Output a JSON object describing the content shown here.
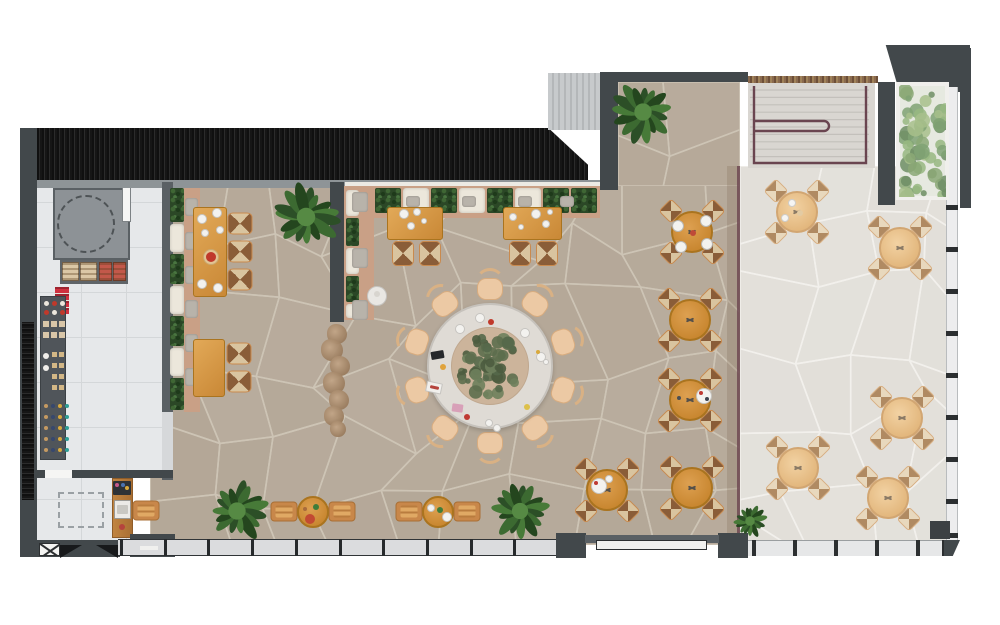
{
  "scene": {
    "description": "Top-down 3D rendered floor plan of a restaurant: kitchen with shelving at left, host desk, indoor dining room with banquettes and flagstone floor, large communal round table with planted centerpiece, staircase at top right, and an outdoor terrace with five tables",
    "visible_text": "none"
  },
  "palette": {
    "wall_dark": "#42484b",
    "wall_black": "#161616",
    "stone_indoor": "#b4a797",
    "stone_grout": "#cdc4b5",
    "terrace": "#e2dfd9",
    "kitchen_tile": "#e6e8ea",
    "wood_table": "#d0903d",
    "terrace_wood": "#e9c291",
    "banquette_tan": "#c9a086",
    "hedge_green": "#2b4726",
    "cushion_cream": "#ece7db",
    "railing_maroon": "#6a4550",
    "accent_red": "#c0392b",
    "plant_green": "#3c6a31"
  },
  "floors": [
    {
      "name": "dining-floor",
      "cls": "stoneA",
      "x": 150,
      "y": 182,
      "w": 590,
      "h": 363,
      "mesh": "in",
      "seed": 11
    },
    {
      "name": "dining-floor-extension",
      "cls": "stoneA",
      "x": 618,
      "y": 82,
      "w": 122,
      "h": 104,
      "mesh": "in",
      "seed": 23
    },
    {
      "name": "terrace-floor",
      "cls": "stoneT",
      "x": 740,
      "y": 166,
      "w": 208,
      "h": 376,
      "mesh": "ter",
      "seed": 37
    },
    {
      "name": "stair-floor",
      "cls": "stairf",
      "x": 748,
      "y": 82,
      "w": 127,
      "h": 86,
      "mesh": "none",
      "seed": 1
    },
    {
      "name": "kitchen-floor",
      "cls": "tile",
      "x": 37,
      "y": 186,
      "w": 125,
      "h": 286,
      "mesh": "none",
      "seed": 1
    },
    {
      "name": "host-floor",
      "cls": "tile",
      "x": 37,
      "y": 478,
      "w": 96,
      "h": 66,
      "mesh": "none",
      "seed": 1
    }
  ],
  "kitchen": {
    "dark_zone": [
      53,
      188,
      77,
      72
    ],
    "dashed_circle": [
      86,
      224,
      29
    ],
    "door": [
      122,
      184,
      9,
      38
    ],
    "counter": [
      60,
      260,
      68,
      24
    ],
    "crates": [
      [
        62,
        262,
        17,
        19,
        "#dbc7a6"
      ],
      [
        80,
        262,
        17,
        19,
        "#dbc7a6"
      ],
      [
        99,
        262,
        13,
        19,
        "#c2584a"
      ],
      [
        113,
        262,
        13,
        19,
        "#c2584a"
      ]
    ],
    "red_stack": [
      55,
      287,
      14,
      27
    ],
    "shelf": [
      40,
      296,
      26,
      164
    ],
    "shelf_cols": [
      "#c49a62",
      "#37486e",
      "#d9a93c",
      "#2f9f96"
    ],
    "dashed_rect": [
      58,
      492,
      46,
      36
    ]
  },
  "walls": [
    {
      "name": "north-wall",
      "cls": "hatch",
      "x": 22,
      "y": 128,
      "w": 566,
      "h": 54,
      "clip": "polygon(0% 0%,93% 0%,100% 68%,100% 100%,0% 100%)",
      "shadow": true
    },
    {
      "name": "north-wall-edge",
      "cls": "grayedge",
      "x": 22,
      "y": 180,
      "w": 596,
      "h": 8
    },
    {
      "name": "west-wall",
      "cls": "dark",
      "x": 20,
      "y": 128,
      "w": 17,
      "h": 380
    },
    {
      "name": "west-wall-hatch",
      "cls": "hatchv",
      "x": 22,
      "y": 322,
      "w": 12,
      "h": 184
    },
    {
      "name": "west-wall-south",
      "cls": "dark",
      "x": 20,
      "y": 500,
      "w": 17,
      "h": 57
    },
    {
      "name": "southwest-wall",
      "cls": "dark",
      "x": 37,
      "y": 540,
      "w": 83,
      "h": 17
    },
    {
      "name": "glass-block",
      "cls": "lightblock",
      "x": 548,
      "y": 73,
      "w": 52,
      "h": 57
    },
    {
      "name": "mid-wall-strip",
      "cls": "dark",
      "x": 600,
      "y": 72,
      "w": 18,
      "h": 118
    },
    {
      "name": "mid-top-wall",
      "cls": "dark",
      "x": 600,
      "y": 72,
      "w": 148,
      "h": 10
    },
    {
      "name": "dining-partition-wall",
      "cls": "dark",
      "x": 330,
      "y": 182,
      "w": 14,
      "h": 140
    },
    {
      "name": "kitchen-partition-wall",
      "cls": "dark2",
      "x": 162,
      "y": 182,
      "w": 11,
      "h": 298
    },
    {
      "name": "kitchen-pass-window",
      "cls": "grayedge",
      "x": 162,
      "y": 412,
      "w": 11,
      "h": 58,
      "bg": "#d6d8da"
    },
    {
      "name": "host-north-wall",
      "cls": "dark",
      "x": 37,
      "y": 470,
      "w": 136,
      "h": 8
    },
    {
      "name": "host-door-leaf",
      "cls": "grayedge",
      "x": 45,
      "y": 470,
      "w": 27,
      "h": 8,
      "bg": "#f5f5f4"
    },
    {
      "name": "service-block",
      "cls": "dark",
      "x": 130,
      "y": 534,
      "w": 45,
      "h": 23
    },
    {
      "name": "northeast-corner-wall",
      "cls": "dark",
      "x": 872,
      "y": 45,
      "w": 98,
      "h": 47,
      "clip": "polygon(14% 0%,100% 0%,100% 100%,28% 100%)"
    },
    {
      "name": "northeast-vertical-wall",
      "cls": "dark",
      "x": 878,
      "y": 82,
      "w": 17,
      "h": 123
    },
    {
      "name": "far-right-wall",
      "cls": "dark",
      "x": 960,
      "y": 48,
      "w": 11,
      "h": 160
    },
    {
      "name": "stair-top-edge",
      "cls": "speckle",
      "x": 748,
      "y": 76,
      "w": 130,
      "h": 7
    }
  ],
  "banquette": {
    "north_sill": [
      345,
      182,
      255,
      7
    ],
    "north_platform": [
      345,
      186,
      255,
      32
    ],
    "north_boxes": [
      [
        347,
        "c"
      ],
      [
        375,
        "h"
      ],
      [
        403,
        "c"
      ],
      [
        431,
        "h"
      ],
      [
        459,
        "c"
      ],
      [
        487,
        "h"
      ],
      [
        515,
        "c"
      ],
      [
        543,
        "h"
      ],
      [
        571,
        "h"
      ]
    ],
    "north_box_y": 188,
    "north_box_w": 26,
    "north_box_h": 25,
    "north_pillows": [
      [
        350,
        196
      ],
      [
        406,
        196
      ],
      [
        462,
        196
      ],
      [
        518,
        196
      ],
      [
        560,
        196
      ]
    ],
    "west_platform": [
      184,
      188,
      16,
      224
    ],
    "west_boxes": [
      [
        188,
        34,
        "h"
      ],
      [
        224,
        28,
        "c"
      ],
      [
        254,
        30,
        "h"
      ],
      [
        286,
        28,
        "c"
      ],
      [
        316,
        30,
        "h"
      ],
      [
        348,
        28,
        "c"
      ],
      [
        378,
        32,
        "h"
      ]
    ],
    "west_box_x": 170,
    "west_box_w": 14,
    "west_pillows": [
      [
        185,
        198
      ],
      [
        185,
        232
      ],
      [
        185,
        266
      ],
      [
        185,
        300
      ],
      [
        185,
        334
      ],
      [
        185,
        368
      ]
    ],
    "mid_platform": [
      344,
      186,
      30,
      134
    ],
    "mid_boxes": [
      [
        190,
        26,
        "c"
      ],
      [
        218,
        28,
        "h"
      ],
      [
        248,
        26,
        "c"
      ],
      [
        276,
        26,
        "h"
      ],
      [
        304,
        14,
        "c"
      ]
    ],
    "mid_box_x": 346,
    "mid_box_w": 13,
    "mid_pillows": [
      [
        352,
        192
      ],
      [
        352,
        248
      ],
      [
        352,
        300
      ]
    ]
  },
  "tables": {
    "round4_r": 21,
    "round4_indoor": [
      [
        692,
        232
      ],
      [
        690,
        320
      ],
      [
        690,
        400
      ],
      [
        692,
        488
      ],
      [
        607,
        490
      ]
    ],
    "round4_terrace": [
      [
        797,
        212
      ],
      [
        900,
        248
      ],
      [
        902,
        418
      ],
      [
        798,
        468
      ],
      [
        888,
        498
      ]
    ],
    "two_top_r": 16,
    "two_tops": [
      [
        313,
        512
      ],
      [
        438,
        512
      ]
    ],
    "rect": [
      {
        "x": 193,
        "y": 207,
        "w": 34,
        "h": 90,
        "chairs": [
          [
            229,
            211,
            "L"
          ],
          [
            229,
            239,
            "L"
          ],
          [
            229,
            267,
            "L"
          ]
        ]
      },
      {
        "x": 193,
        "y": 339,
        "w": 32,
        "h": 58,
        "chairs": [
          [
            228,
            341,
            "L"
          ],
          [
            228,
            369,
            "L"
          ]
        ]
      },
      {
        "x": 387,
        "y": 207,
        "w": 56,
        "h": 33,
        "chairs": [
          [
            392,
            241,
            "U"
          ],
          [
            419,
            241,
            "U"
          ]
        ]
      },
      {
        "x": 503,
        "y": 207,
        "w": 59,
        "h": 33,
        "chairs": [
          [
            509,
            241,
            "U"
          ],
          [
            536,
            241,
            "U"
          ]
        ]
      }
    ],
    "communal": {
      "x": 490,
      "y": 366,
      "outer_r": 63,
      "inner_r": 39,
      "chair_dist": 77,
      "chair_angles": [
        90,
        126,
        162,
        198,
        234,
        270,
        306,
        342,
        18,
        54
      ]
    },
    "pedestal": [
      377,
      296,
      10
    ]
  },
  "plants": [
    [
      306,
      217,
      33
    ],
    [
      643,
      112,
      31
    ],
    [
      237,
      511,
      31
    ],
    [
      520,
      511,
      29
    ],
    [
      750,
      521,
      17
    ]
  ],
  "planter_bed": [
    896,
    82,
    53,
    118
  ],
  "branches": [
    [
      337,
      334,
      10
    ],
    [
      332,
      350,
      11
    ],
    [
      340,
      366,
      10
    ],
    [
      334,
      383,
      11
    ],
    [
      339,
      400,
      10
    ],
    [
      334,
      416,
      10
    ],
    [
      338,
      429,
      8
    ]
  ],
  "divider": {
    "tint": [
      727,
      166,
      13,
      376
    ],
    "line": [
      737,
      166,
      3,
      376
    ]
  },
  "stairs": {
    "zone": [
      748,
      82,
      127,
      86
    ],
    "rail_color": "#6a4550"
  },
  "windows": {
    "south_band": [
      118,
      539,
      438,
      17
    ],
    "south_post_start": 120,
    "south_post_step": 43.7,
    "south_post_count": 11,
    "terrace_band": [
      748,
      540,
      200,
      16
    ],
    "terrace_posts": [
      752,
      793,
      834,
      875,
      916,
      942
    ],
    "right_band": [
      946,
      85,
      12,
      455
    ],
    "right_posts": [
      205,
      247,
      289,
      331,
      373,
      415,
      457,
      499,
      533
    ],
    "right_cap": [
      944,
      75,
      18,
      12
    ],
    "entrance_blocks": [
      [
        556,
        533,
        30,
        25
      ],
      [
        718,
        533,
        30,
        25
      ]
    ],
    "entrance_lintel": [
      585,
      535,
      134,
      8
    ],
    "entrance_door": [
      596,
      540,
      111,
      10
    ],
    "x_window": [
      39,
      543,
      21,
      13
    ],
    "door_wedges": [
      [
        60,
        545,
        22,
        13
      ],
      [
        96,
        545,
        22,
        13
      ]
    ],
    "service_slit": [
      140,
      546,
      18,
      4
    ],
    "terrace_dark_square": [
      930,
      521,
      20,
      18
    ],
    "corner_wedge": [
      944,
      540,
      16,
      16
    ]
  },
  "decor": [
    {
      "t": "c",
      "x": 480,
      "y": 318,
      "r": 5,
      "f": "#f3f2ef",
      "b": "#c6c4c0"
    },
    {
      "t": "c",
      "x": 491,
      "y": 322,
      "r": 3,
      "f": "#c0392b"
    },
    {
      "t": "c",
      "x": 460,
      "y": 329,
      "r": 5,
      "f": "#f3f2ef",
      "b": "#c6c4c0"
    },
    {
      "t": "c",
      "x": 525,
      "y": 333,
      "r": 5,
      "f": "#f3f2ef",
      "b": "#c6c4c0"
    },
    {
      "t": "c",
      "x": 541,
      "y": 357,
      "r": 5,
      "f": "#f3f2ef",
      "b": "#c6c4c0"
    },
    {
      "t": "c",
      "x": 546,
      "y": 362,
      "r": 3,
      "f": "#f3f2ef",
      "b": "#c6c4c0"
    },
    {
      "t": "c",
      "x": 538,
      "y": 352,
      "r": 2,
      "f": "#d9a93c"
    },
    {
      "t": "r",
      "x": 431,
      "y": 351,
      "w": 13,
      "h": 8,
      "f": "#26282b",
      "rot": -10
    },
    {
      "t": "c",
      "x": 443,
      "y": 367,
      "r": 3,
      "f": "#e0a33c"
    },
    {
      "t": "r",
      "x": 426,
      "y": 382,
      "w": 16,
      "h": 11,
      "f": "#f1efec",
      "rot": 12,
      "b": "#c6c4c0"
    },
    {
      "t": "r",
      "x": 430,
      "y": 386,
      "w": 9,
      "h": 3,
      "f": "#b5443d",
      "rot": 12
    },
    {
      "t": "r",
      "x": 452,
      "y": 404,
      "w": 11,
      "h": 8,
      "f": "#d8a0b8",
      "rot": 8
    },
    {
      "t": "c",
      "x": 467,
      "y": 417,
      "r": 3,
      "f": "#bf3a33"
    },
    {
      "t": "c",
      "x": 489,
      "y": 423,
      "r": 4,
      "f": "#f3f2ef",
      "b": "#c6c4c0"
    },
    {
      "t": "c",
      "x": 497,
      "y": 428,
      "r": 4,
      "f": "#f3f2ef",
      "b": "#c6c4c0"
    },
    {
      "t": "c",
      "x": 527,
      "y": 407,
      "r": 3,
      "f": "#ddc04a"
    },
    {
      "t": "c",
      "x": 678,
      "y": 226,
      "r": 6,
      "f": "#f3f2ef",
      "b": "#b9b7b3"
    },
    {
      "t": "c",
      "x": 706,
      "y": 221,
      "r": 6,
      "f": "#f3f2ef",
      "b": "#b9b7b3"
    },
    {
      "t": "c",
      "x": 681,
      "y": 247,
      "r": 6,
      "f": "#f3f2ef",
      "b": "#b9b7b3"
    },
    {
      "t": "c",
      "x": 707,
      "y": 244,
      "r": 6,
      "f": "#f3f2ef",
      "b": "#b9b7b3"
    },
    {
      "t": "c",
      "x": 693,
      "y": 233,
      "r": 3,
      "f": "#bf4a38"
    },
    {
      "t": "c",
      "x": 704,
      "y": 396,
      "r": 8,
      "f": "#f3f2ef",
      "b": "#c6c4c0"
    },
    {
      "t": "c",
      "x": 701,
      "y": 393,
      "r": 2,
      "f": "#bf3a33"
    },
    {
      "t": "c",
      "x": 707,
      "y": 399,
      "r": 2,
      "f": "#3e4450"
    },
    {
      "t": "c",
      "x": 679,
      "y": 398,
      "r": 2,
      "f": "#4a4f54"
    },
    {
      "t": "c",
      "x": 599,
      "y": 486,
      "r": 8,
      "f": "#f3f2ef",
      "b": "#c6c4c0"
    },
    {
      "t": "c",
      "x": 596,
      "y": 483,
      "r": 2,
      "f": "#bf3a33"
    },
    {
      "t": "c",
      "x": 609,
      "y": 479,
      "r": 4,
      "f": "#f3f2ef",
      "b": "#c6c4c0"
    },
    {
      "t": "c",
      "x": 310,
      "y": 519,
      "r": 5,
      "f": "#c24a32"
    },
    {
      "t": "c",
      "x": 316,
      "y": 507,
      "r": 3,
      "f": "#3f7d3a"
    },
    {
      "t": "c",
      "x": 305,
      "y": 509,
      "r": 2,
      "f": "#a86b3c"
    },
    {
      "t": "c",
      "x": 431,
      "y": 508,
      "r": 4,
      "f": "#f3f2ef",
      "b": "#c6c4c0"
    },
    {
      "t": "c",
      "x": 447,
      "y": 517,
      "r": 5,
      "f": "#f3f2ef",
      "b": "#c6c4c0"
    },
    {
      "t": "c",
      "x": 440,
      "y": 510,
      "r": 3,
      "f": "#3f7d3a"
    },
    {
      "t": "c",
      "x": 792,
      "y": 203,
      "r": 4,
      "f": "#f6f5f3",
      "b": "#cfcdc9"
    },
    {
      "t": "c",
      "x": 785,
      "y": 218,
      "r": 4,
      "f": "#f6f5f3",
      "b": "#cfcdc9"
    },
    {
      "t": "c",
      "x": 800,
      "y": 213,
      "r": 3,
      "f": "#e3cba3"
    },
    {
      "t": "c",
      "x": 202,
      "y": 219,
      "r": 5,
      "f": "#f3f2ef",
      "b": "#c6c4c0"
    },
    {
      "t": "c",
      "x": 217,
      "y": 213,
      "r": 5,
      "f": "#f3f2ef",
      "b": "#c6c4c0"
    },
    {
      "t": "c",
      "x": 220,
      "y": 230,
      "r": 4,
      "f": "#f3f2ef",
      "b": "#c6c4c0"
    },
    {
      "t": "c",
      "x": 205,
      "y": 233,
      "r": 4,
      "f": "#f3f2ef",
      "b": "#c6c4c0"
    },
    {
      "t": "c",
      "x": 211,
      "y": 257,
      "r": 8,
      "f": "#e2c493",
      "b": "#caa86f"
    },
    {
      "t": "c",
      "x": 211,
      "y": 257,
      "r": 5,
      "f": "#c0392b"
    },
    {
      "t": "c",
      "x": 202,
      "y": 284,
      "r": 5,
      "f": "#f3f2ef",
      "b": "#c6c4c0"
    },
    {
      "t": "c",
      "x": 218,
      "y": 288,
      "r": 5,
      "f": "#f3f2ef",
      "b": "#c6c4c0"
    },
    {
      "t": "c",
      "x": 404,
      "y": 214,
      "r": 5,
      "f": "#f3f2ef",
      "b": "#c6c4c0"
    },
    {
      "t": "c",
      "x": 417,
      "y": 212,
      "r": 4,
      "f": "#f3f2ef",
      "b": "#c6c4c0"
    },
    {
      "t": "c",
      "x": 411,
      "y": 226,
      "r": 4,
      "f": "#f3f2ef",
      "b": "#c6c4c0"
    },
    {
      "t": "c",
      "x": 424,
      "y": 221,
      "r": 3,
      "f": "#f3f2ef",
      "b": "#c6c4c0"
    },
    {
      "t": "c",
      "x": 536,
      "y": 214,
      "r": 5,
      "f": "#f3f2ef",
      "b": "#c6c4c0"
    },
    {
      "t": "c",
      "x": 513,
      "y": 217,
      "r": 4,
      "f": "#f3f2ef",
      "b": "#c6c4c0"
    },
    {
      "t": "c",
      "x": 546,
      "y": 224,
      "r": 4,
      "f": "#f3f2ef",
      "b": "#c6c4c0"
    },
    {
      "t": "c",
      "x": 521,
      "y": 227,
      "r": 3,
      "f": "#f3f2ef",
      "b": "#c6c4c0"
    },
    {
      "t": "c",
      "x": 550,
      "y": 212,
      "r": 3,
      "f": "#f3f2ef",
      "b": "#c6c4c0"
    },
    {
      "t": "r",
      "x": 113,
      "y": 481,
      "w": 18,
      "h": 14,
      "f": "#2e3236"
    },
    {
      "t": "c",
      "x": 117,
      "y": 485,
      "r": 2,
      "f": "#c75a8a"
    },
    {
      "t": "c",
      "x": 123,
      "y": 485,
      "r": 2,
      "f": "#4a72b0"
    },
    {
      "t": "c",
      "x": 127,
      "y": 488,
      "r": 2,
      "f": "#d9a93c"
    },
    {
      "t": "r",
      "x": 114,
      "y": 500,
      "w": 17,
      "h": 19,
      "f": "#eceae7",
      "b": "#9a9894"
    },
    {
      "t": "r",
      "x": 117,
      "y": 505,
      "w": 11,
      "h": 9,
      "f": "#c9c7c2"
    },
    {
      "t": "c",
      "x": 122,
      "y": 527,
      "r": 3,
      "f": "#b5443d"
    },
    {
      "t": "c",
      "x": 377,
      "y": 294,
      "r": 3,
      "f": "#d8d5cf"
    }
  ]
}
